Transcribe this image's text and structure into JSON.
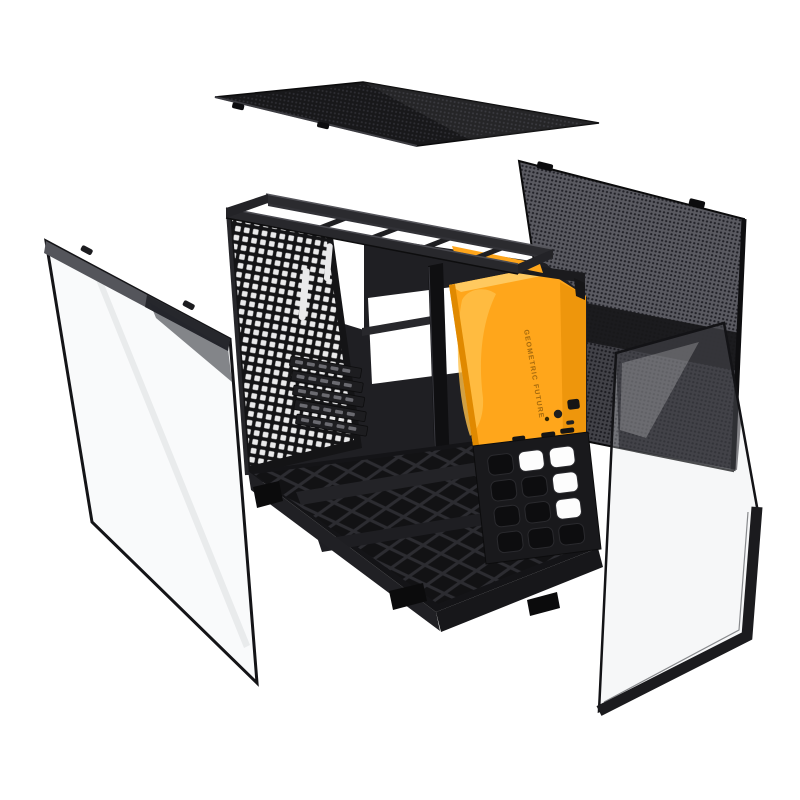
{
  "scene": {
    "background": "#ffffff",
    "description": "Exploded product photo of a PC tower case: top mesh panel, side mesh panel, two tempered glass side panels, black chassis frame with perforated rear tray, dust-filter base and orange front panel"
  },
  "branding": {
    "vertical_logo_text": "GEOMETRIC FUTURE"
  },
  "colors": {
    "background": "#ffffff",
    "accent_orange": "#FFA61B",
    "orange_highlight": "#FFC04A",
    "orange_bevel": "#FFC95F",
    "orange_shadow": "#E08900",
    "orange_underside": "#B06A00",
    "logo_text_color": "rgba(90,55,0,0.55)",
    "chassis_dark": "#1B1B1E",
    "chassis_mid": "#2B2B2F",
    "chassis_light": "#4A4B51",
    "mesh_gray": "#5A5A61",
    "mesh_dot": "#212127",
    "panel_dark": "#151517",
    "glass_frame": "#17171A",
    "glass_band_gray": "#54555B",
    "perforation_light": "#E9E9EA",
    "white": "#FFFFFF"
  }
}
